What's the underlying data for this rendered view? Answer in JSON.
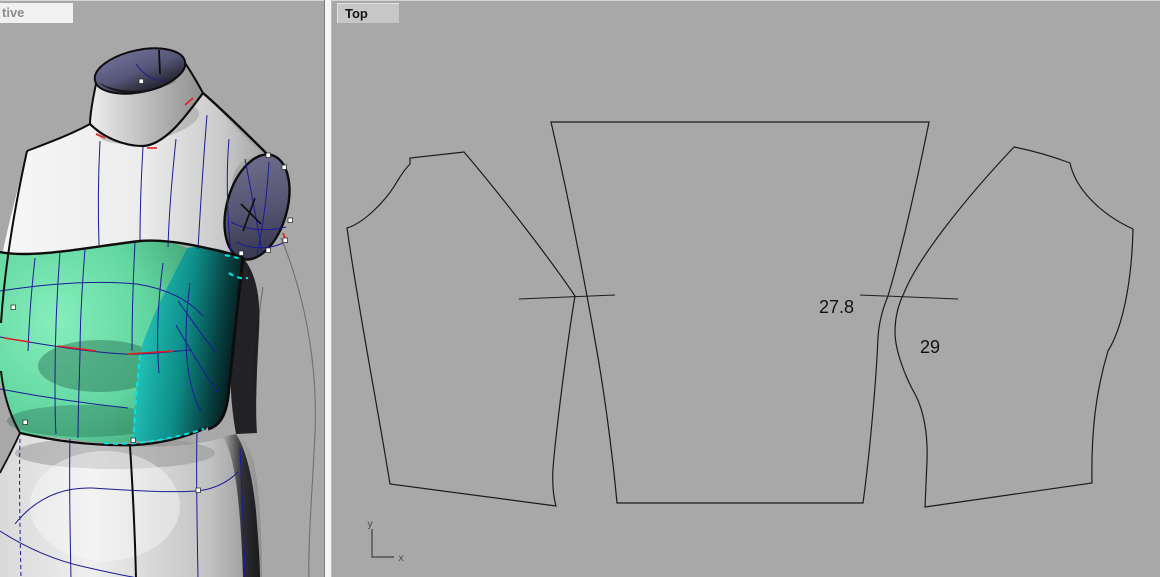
{
  "viewports": {
    "perspective": {
      "label": "tive",
      "content": "3d-dress-form-with-garment-panels"
    },
    "top": {
      "label": "Top",
      "content": "flat-pattern-pieces",
      "measurements": [
        {
          "value": "27.8"
        },
        {
          "value": "29"
        }
      ],
      "axis": {
        "x": "x",
        "y": "y"
      }
    }
  },
  "colors": {
    "viewport_bg": "#a8a8a8",
    "outline": "#1c1c1c",
    "garment_green": "#62d6a0",
    "garment_teal": "#1ecfc8",
    "isocurve_navy": "#1b1b96",
    "selection_cyan": "#00e6e6",
    "seam_red": "#e02020",
    "surface_slate": "#55557a",
    "dimension_text": "#111111",
    "axis_gizmo": "#4f4f4f"
  }
}
